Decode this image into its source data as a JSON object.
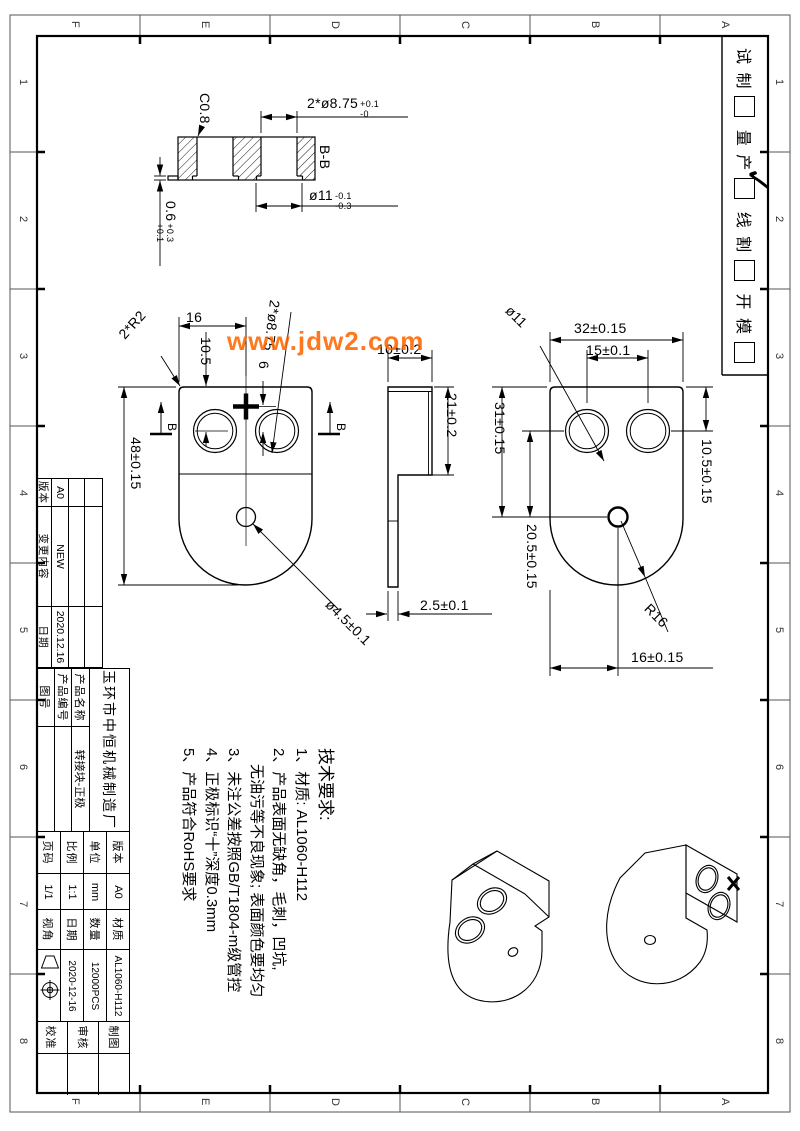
{
  "watermark": "www.jdw2.com",
  "accent_color": "#ff6600",
  "zones": {
    "letters": [
      "F",
      "E",
      "D",
      "C",
      "B",
      "A"
    ],
    "numbers": [
      "1",
      "2",
      "3",
      "4",
      "5",
      "6",
      "7",
      "8"
    ]
  },
  "status_box": {
    "trial": "试 制",
    "mass": "量 产",
    "wire": "线 割",
    "mold": "开 模",
    "check_glyph": "✓"
  },
  "section_view": {
    "label": "B-B",
    "chamfer": "C0.8",
    "holes_dia": "2*ø8.75",
    "holes_tol_up": "+0.1",
    "holes_tol_dn": "-0",
    "bore_dia": "ø11",
    "bore_tol_up": "-0.1",
    "bore_tol_dn": "-0.3",
    "lip": "0.6",
    "lip_tol_up": "+0.3",
    "lip_tol_dn": "+0.1"
  },
  "front_view": {
    "half_width": "16",
    "top_to_hole": "10.5",
    "plus_offset": "6",
    "height": "48±0.15",
    "corner_r": "2*R2",
    "holes_dia": "2*ø8.75",
    "center_hole": "ø4.5±0.1",
    "cut_label": "B"
  },
  "side_view": {
    "boss_width": "10±0.2",
    "boss_height": "21±0.2",
    "thickness": "2.5±0.1"
  },
  "right_view": {
    "width": "32±0.15",
    "hole_pitch": "15±0.1",
    "hole_dia": "ø11",
    "edge_to_center": "31±0.15",
    "hole_to_center": "20.5±0.15",
    "top_to_hole": "10.5±0.15",
    "bottom_r": "R16",
    "center_offset": "16±0.15"
  },
  "tech_req": {
    "title": "技术要求:",
    "item1": "1、材质: AL1060-H112",
    "item2": "2、产品表面无缺角，毛刺，凹坑,",
    "item2b": "无油污等不良现象; 表面颜色要均匀",
    "item3": "3、未注公差按照GB/T1804-m级管控",
    "item4": "4、正极标识“十”深度0.3mm",
    "item5": "5、产品符合RoHS要求"
  },
  "revision_table": {
    "version_label": "版本",
    "change_label": "变更内容",
    "date_label": "日期",
    "version": "A0",
    "change": "NEW",
    "date": "2020.12.16"
  },
  "title_block": {
    "company": "玉环市中恒机械制造厂",
    "product_name_label": "产品名称",
    "product_name": "转接块-正极",
    "product_code_label": "产品编号",
    "drawing_no_label": "图号",
    "version_label": "版本",
    "version": "A0",
    "unit_label": "单位",
    "unit": "mm",
    "scale_label": "比例",
    "scale": "1:1",
    "page_label": "页码",
    "page": "1/1",
    "material_label": "材质",
    "material": "AL1060-H112",
    "qty_label": "数量",
    "qty": "12000PCS",
    "date_label": "日期",
    "date": "2020-12-16",
    "view_angle_label": "视角",
    "draft_label": "制图",
    "review_label": "审核",
    "approve_label": "校准"
  }
}
